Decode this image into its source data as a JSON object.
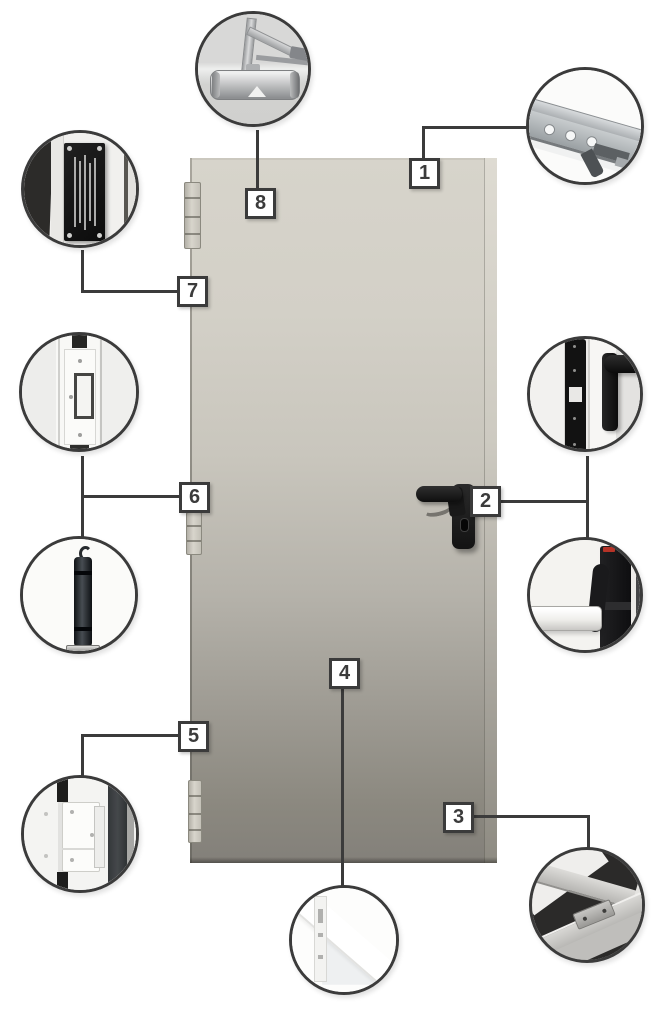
{
  "diagram": {
    "subject": "steel-door-hardware-callout-diagram",
    "background_color": "#ffffff",
    "outline_color": "#3b3b3b",
    "door": {
      "color_top": "#d7d4cb",
      "color_bottom": "#83807a",
      "edge_color": "#8e8b82",
      "handle_color": "#1a1a1a"
    },
    "callouts": [
      {
        "number": "1",
        "detail": "frame-corner-anchor-bracket"
      },
      {
        "number": "2",
        "detail": "mortise-lock-edge-handle-and-panic-bar"
      },
      {
        "number": "3",
        "detail": "door-frame-corner-profile"
      },
      {
        "number": "4",
        "detail": "door-leaf-bottom-corner"
      },
      {
        "number": "5",
        "detail": "bottom-hinge"
      },
      {
        "number": "6",
        "detail": "middle-hinge-and-closing-spring"
      },
      {
        "number": "7",
        "detail": "certification-data-plate"
      },
      {
        "number": "8",
        "detail": "overhead-door-closer"
      }
    ]
  }
}
